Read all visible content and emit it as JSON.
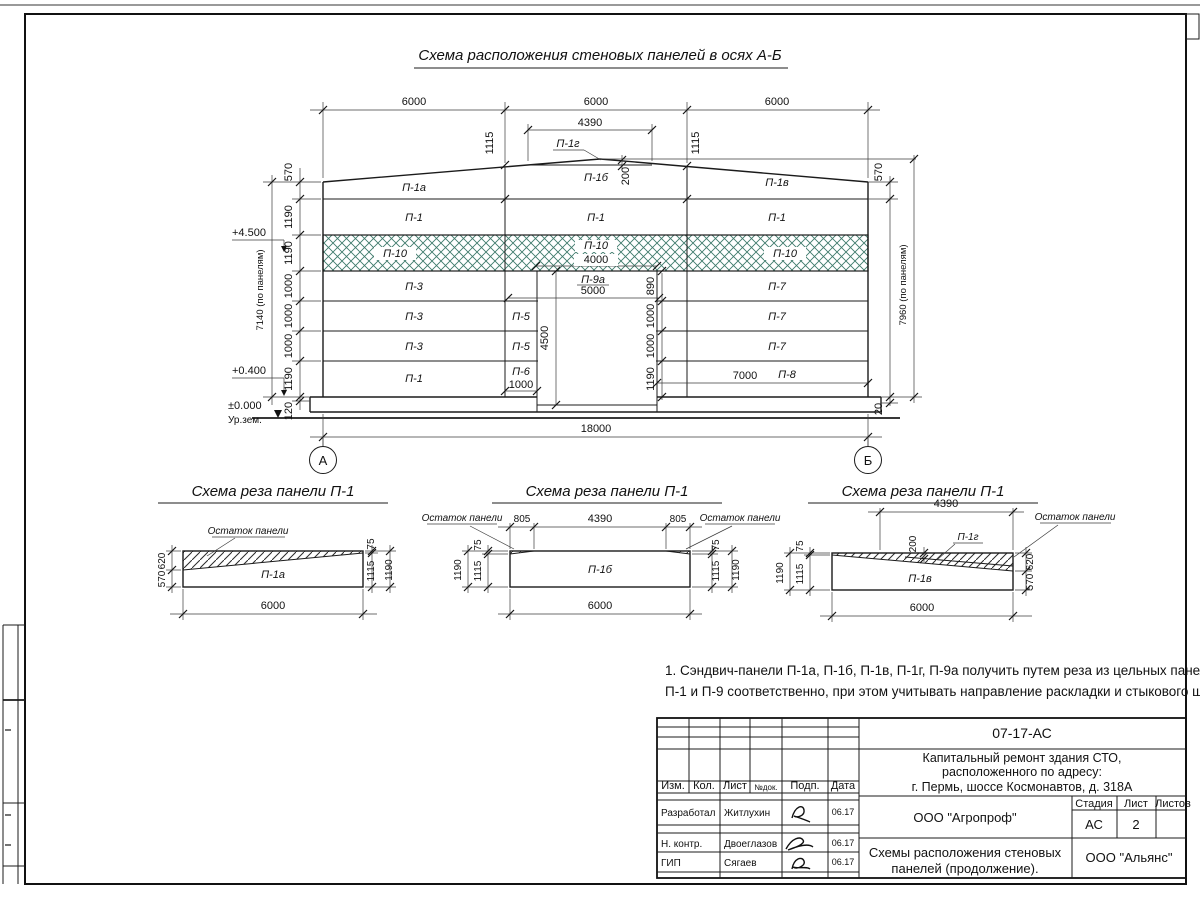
{
  "sheet": {
    "title": "Схема расположения стеновых панелей в осях А-Б"
  },
  "elev": {
    "axisA": "А",
    "axisB": "Б",
    "spans": [
      "6000",
      "6000",
      "6000"
    ],
    "total": "18000",
    "apexW": "4390",
    "apex200": "200",
    "slopeL": "1115",
    "slopeR": "1115",
    "chainL": [
      "570",
      "1190",
      "1190",
      "1000",
      "1000",
      "1000",
      "1190",
      "120"
    ],
    "totalL": "7140 (по панелям)",
    "topR": "570",
    "totalR": "7960 (по панелям)",
    "botR": "20",
    "p10w": "4000",
    "p9aw": "5000",
    "doorH": "4500",
    "chainD": [
      "890",
      "1000",
      "1000",
      "1190"
    ],
    "p6w": "1000",
    "p8w": "7000",
    "lev45": "+4.500",
    "lev04": "+0.400",
    "lev00": "±0.000",
    "ground": "Ур.зем.",
    "r1": [
      "П-1а",
      "П-1б",
      "П-1в"
    ],
    "p1g": "П-1г",
    "r2": [
      "П-1",
      "П-1",
      "П-1"
    ],
    "r3": [
      "П-10",
      "П-10",
      "П-10"
    ],
    "r4": [
      "П-3",
      "П-9а",
      "П-7"
    ],
    "r5": [
      "П-3",
      "П-5",
      "П-7"
    ],
    "r6": [
      "П-3",
      "П-5",
      "П-7"
    ],
    "r7": [
      "П-1",
      "П-6",
      "П-8"
    ]
  },
  "cut1": {
    "title": "Схема реза панели П-1",
    "panel": "П-1а",
    "rem": "Остаток панели",
    "d620": "620",
    "d570": "570",
    "d75": "75",
    "d1115": "1115",
    "d1190": "1190",
    "w": "6000"
  },
  "cut2": {
    "title": "Схема реза панели П-1",
    "panel": "П-1б",
    "remL": "Остаток панели",
    "remR": "Остаток панели",
    "d805l": "805",
    "d4390": "4390",
    "d805r": "805",
    "l75": "75",
    "l1115": "1115",
    "l1190": "1190",
    "r75": "75",
    "r1115": "1115",
    "r1190": "1190",
    "w": "6000"
  },
  "cut3": {
    "title": "Схема реза панели П-1",
    "panel": "П-1в",
    "piece": "П-1г",
    "rem": "Остаток панели",
    "d4390": "4390",
    "d200": "200",
    "l75": "75",
    "l1115": "1115",
    "l1190": "1190",
    "r620": "620",
    "r570": "570",
    "w": "6000"
  },
  "note": {
    "l1": "1. Сэндвич-панели П-1а, П-1б, П-1в, П-1г, П-9а получить путем реза из цельных панелей",
    "l2": "П-1 и П-9 соответственно, при этом учитывать направление раскладки и стыкового шва."
  },
  "tb": {
    "code": "07-17-АС",
    "proj1": "Капитальный ремонт здания СТО,",
    "proj2": "расположенного по адресу:",
    "proj3": "г. Пермь, шоссе Космонавтов, д. 318А",
    "hIzm": "Изм.",
    "hKol": "Кол.",
    "hList": "Лист",
    "hNdok": "№док.",
    "hPodp": "Подп.",
    "hData": "Дата",
    "rows": [
      {
        "role": "Разработал",
        "name": "Житлухин",
        "date": "06.17"
      },
      {
        "role": "Н. контр.",
        "name": "Двоеглазов",
        "date": "06.17"
      },
      {
        "role": "ГИП",
        "name": "Сягаев",
        "date": "06.17"
      }
    ],
    "org": "ООО \"Агропроф\"",
    "hStage": "Стадия",
    "hSheet": "Лист",
    "hSheets": "Листов",
    "stage": "АС",
    "sheetNo": "2",
    "doc1": "Схемы расположения стеновых",
    "doc2": "панелей (продолжение).",
    "company": "ООО \"Альянс\""
  },
  "colors": {
    "hatch": "#3e7a6b",
    "line": "#1b1b1b"
  }
}
